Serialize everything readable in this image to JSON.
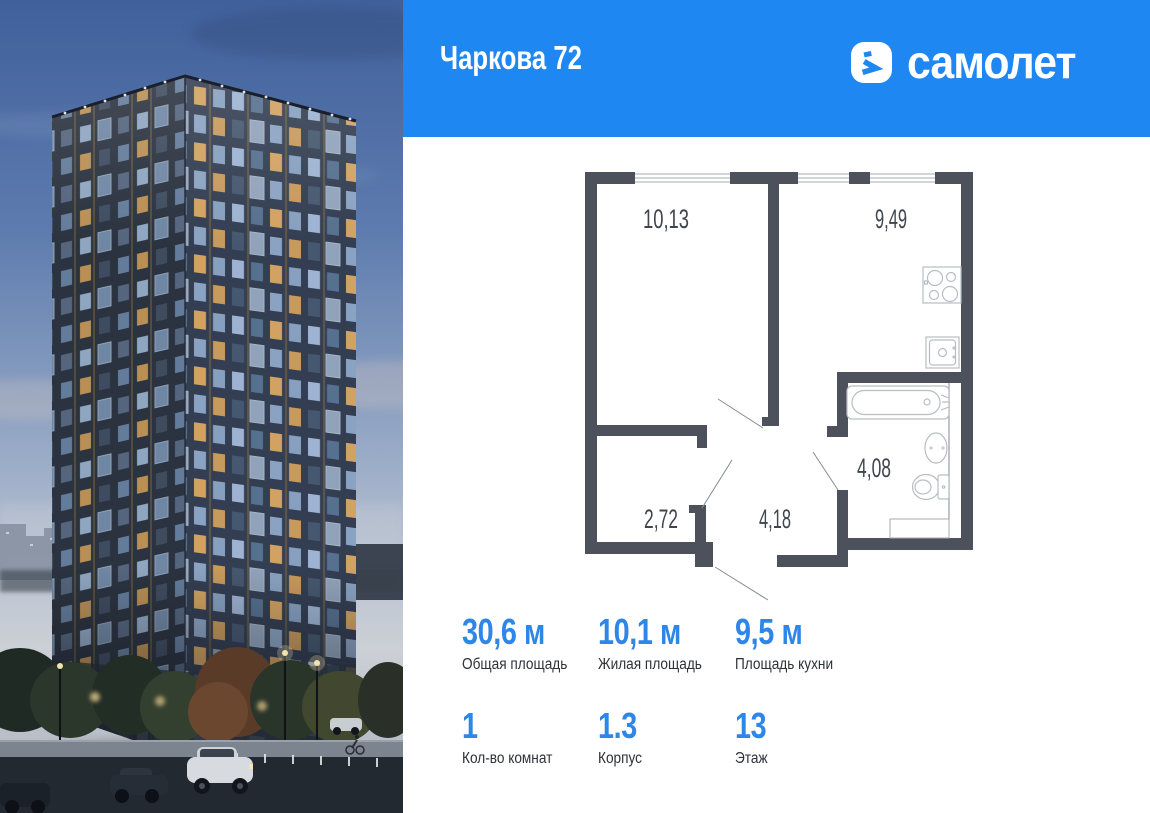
{
  "header": {
    "title": "Чаркова 72",
    "brand": "самолет",
    "background_color": "#1E87F2",
    "text_color": "#FFFFFF"
  },
  "icons": {
    "brand": "samolet-logo-icon",
    "plan_fixtures": [
      "stove-icon",
      "kitchen-sink-icon",
      "bathtub-icon",
      "washbasin-icon",
      "toilet-icon"
    ]
  },
  "floor_plan": {
    "wall_color": "#4C515B",
    "label_color": "#3F444D",
    "rooms": [
      {
        "name": "bedroom",
        "area": "10,13"
      },
      {
        "name": "kitchen-living",
        "area": "9,49"
      },
      {
        "name": "wardrobe",
        "area": "2,72"
      },
      {
        "name": "hallway",
        "area": "4,18"
      },
      {
        "name": "bathroom",
        "area": "4,08"
      }
    ]
  },
  "stats": {
    "accent_color": "#2E86E9",
    "items": [
      {
        "value": "30,6 м",
        "label": "Общая площадь"
      },
      {
        "value": "10,1 м",
        "label": "Жилая площадь"
      },
      {
        "value": "9,5 м",
        "label": "Площадь кухни"
      },
      {
        "value": "1",
        "label": "Кол-во комнат"
      },
      {
        "value": "1.3",
        "label": "Корпус"
      },
      {
        "value": "13",
        "label": "Этаж"
      }
    ]
  }
}
